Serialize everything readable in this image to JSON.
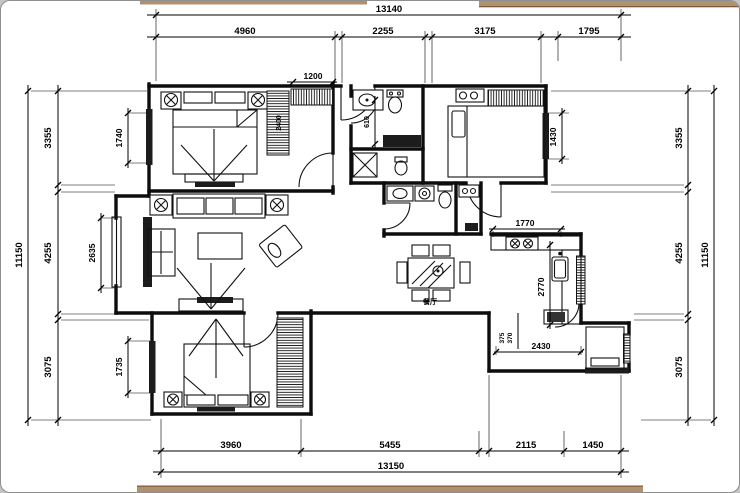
{
  "canvas": {
    "background": "#ffffff",
    "page_background": "#c4c4c4",
    "border_color": "#8f8f8f",
    "accent_strip_color": "#b1906f",
    "accent_strip_edge": "#7c5a3a",
    "line_color": "#000000"
  },
  "floor_plan": {
    "type": "residential-apartment-floor-plan",
    "units": "mm",
    "chains": {
      "top": {
        "overall": "13140",
        "segments": [
          "4960",
          "2255",
          "3175",
          "1795"
        ]
      },
      "bottom": {
        "overall": "13150",
        "segments": [
          "3960",
          "5455",
          "2115",
          "1450"
        ]
      },
      "left": {
        "overall": "11150",
        "segments": [
          "3355",
          "4255",
          "3075"
        ]
      },
      "right": {
        "overall": "11150",
        "segments": [
          "3355",
          "4255",
          "3075"
        ]
      }
    },
    "interior_dims": {
      "bedroom1_window": "1740",
      "bedroom1_closet": "1200",
      "bedroom1_wardrobe": "2400",
      "bathroom1": "610",
      "bedroom2_window": "1430",
      "living_window": "2635",
      "bedroom3_window": "1735",
      "kitchen_counter": "1770",
      "kitchen_run": "2770",
      "balcony_width": "2430",
      "balcony_offset_a": "375",
      "balcony_offset_b": "370"
    },
    "labels": {
      "dining_room": "餐厅"
    }
  }
}
